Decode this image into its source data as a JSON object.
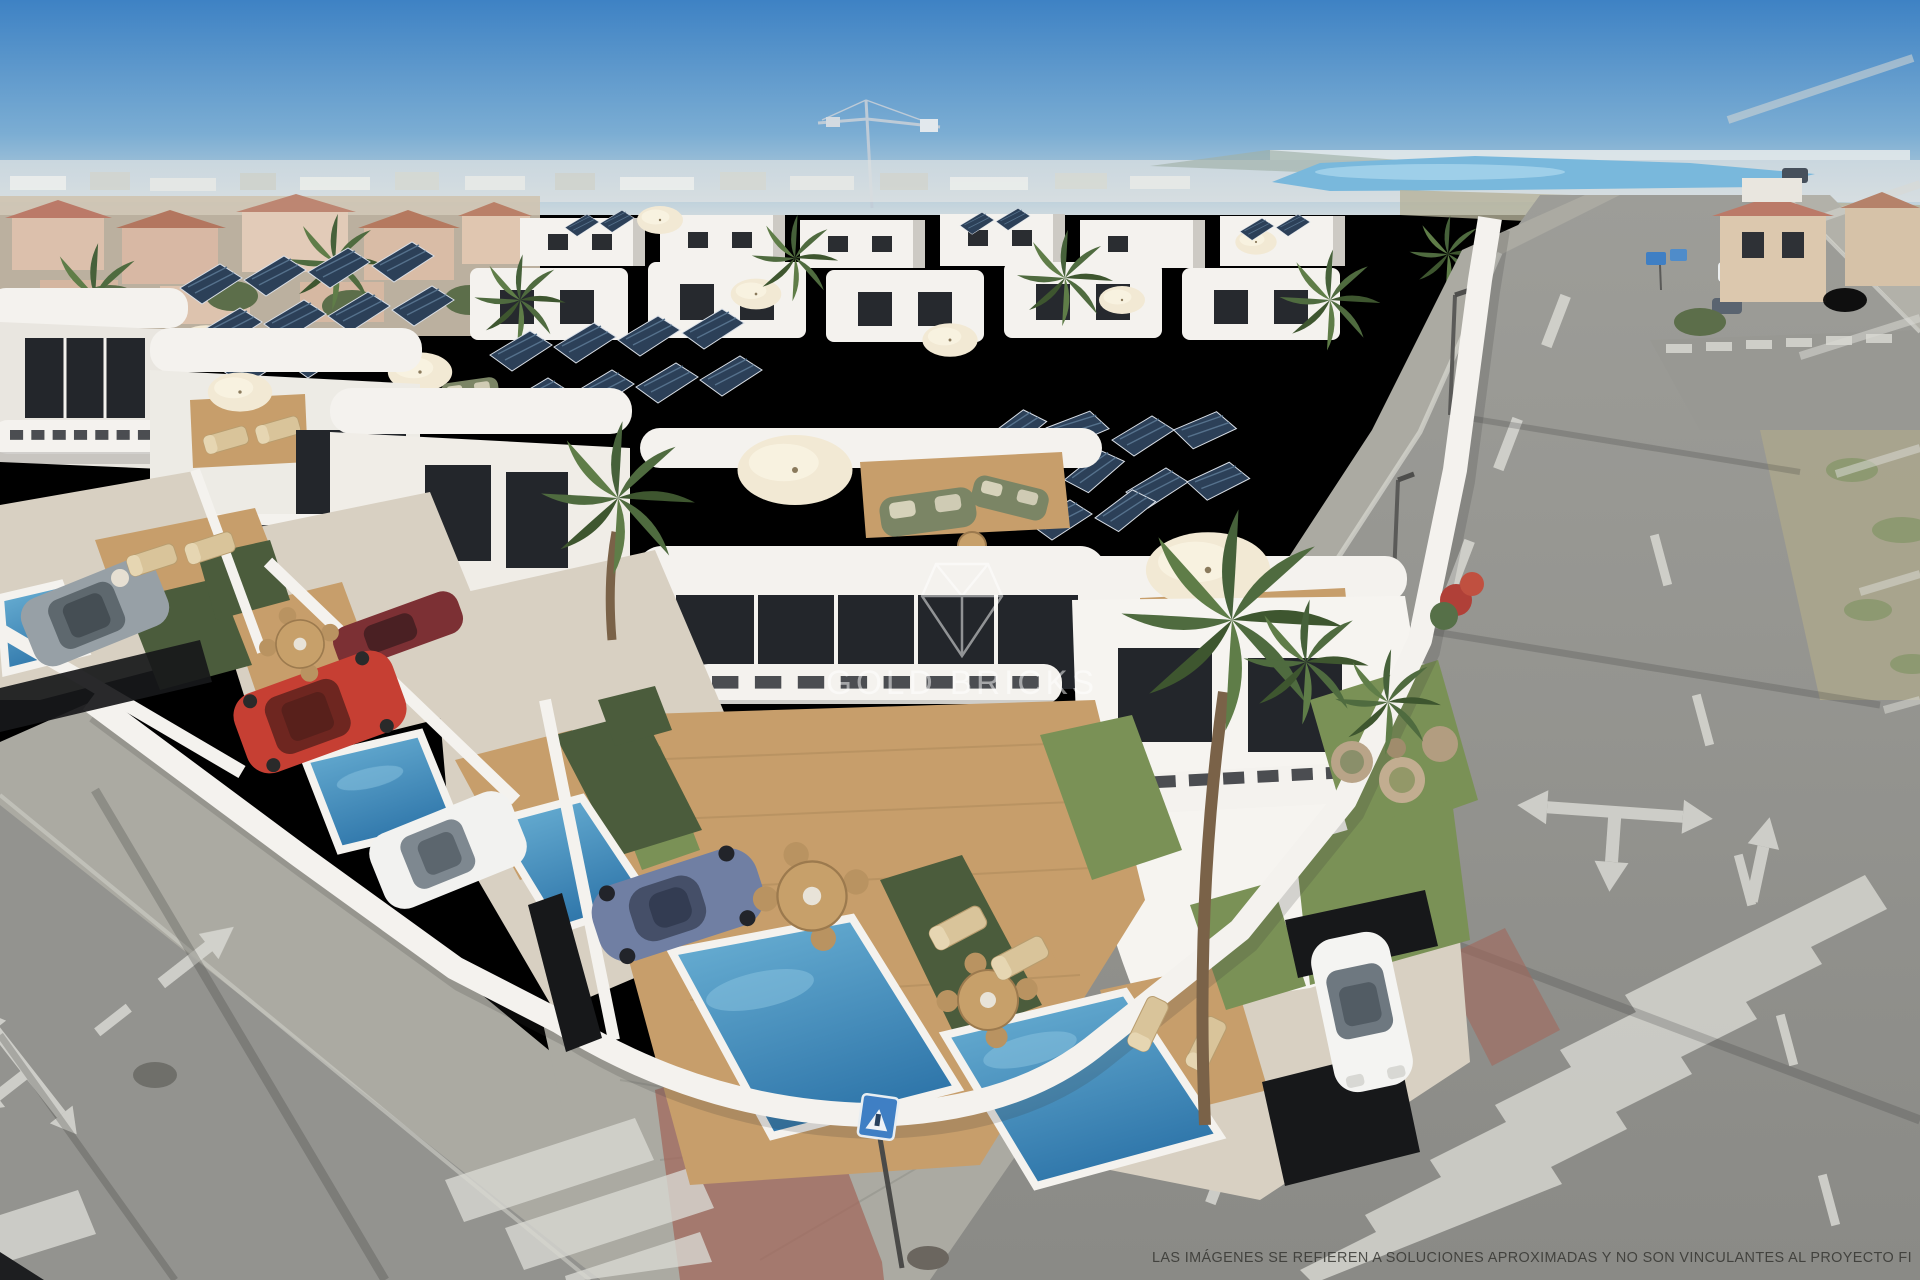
{
  "image": {
    "kind": "aerial-3d-architectural-render",
    "subject": "New-build development of white modern villas with private pools, wooden decks, rooftop solar panels and roof terraces on a street corner; existing town, fields and a blue coastal lagoon on the hazy horizon; construction crane in the sky"
  },
  "watermark": {
    "text": "GOLD BRICKS",
    "logo_icon": "gem-monogram-icon",
    "color": "#ffffff",
    "opacity": "0.5"
  },
  "disclaimer": {
    "text": "LAS IMÁGENES SE REFIEREN A SOLUCIONES APROXIMADAS Y NO SON VINCULANTES AL PROYECTO FI",
    "color": "#33332f"
  },
  "palette": {
    "sky_top": "#3e82c4",
    "sky_mid": "#7badd3",
    "sky_horizon": "#cdd9de",
    "lagoon": "#79b8dc",
    "villa_wall": "#f4f2ee",
    "villa_shadow": "#ddd9d3",
    "glazing": "#23262b",
    "solar_panel": "#2c4058",
    "pool_deep": "#2f76aa",
    "pool_light": "#6db3d6",
    "deck_wood": "#c79e6b",
    "grass": "#7a9156",
    "hedge": "#4b5c3c",
    "palm": "#4f6b3f",
    "road": "#93938f",
    "sidewalk": "#abaaa2",
    "red_paving": "#a1685c",
    "road_marking": "#d9d9d3",
    "terracotta_roof": "#bb7a68",
    "old_town_wall": "#dcc0ac"
  },
  "objects": {
    "cars": [
      {
        "name": "grey-hatchback",
        "color": "#97a0a6"
      },
      {
        "name": "dark-red-car",
        "color": "#7c3034"
      },
      {
        "name": "red-suv",
        "color": "#c63f33"
      },
      {
        "name": "white-suv",
        "color": "#f2f2f0"
      },
      {
        "name": "blue-sports-car",
        "color": "#707fa3"
      },
      {
        "name": "white-city-car",
        "color": "#f4f4f2"
      },
      {
        "name": "distant-white-van",
        "color": "#eceff0"
      },
      {
        "name": "distant-dark-car",
        "color": "#3c4450"
      }
    ],
    "signs": [
      {
        "name": "pedestrian-crossing-sign",
        "color": "#3f7fc4"
      },
      {
        "name": "road-direction-signs",
        "color": "#3f7fc4"
      }
    ],
    "road_markings": [
      "lane-dashes",
      "triple-direction-arrow",
      "straight-arrow",
      "zebra-crossing-right",
      "zebra-crossing-left",
      "parking-bay-stripes",
      "give-way-dashes"
    ],
    "construction_crane": true
  }
}
